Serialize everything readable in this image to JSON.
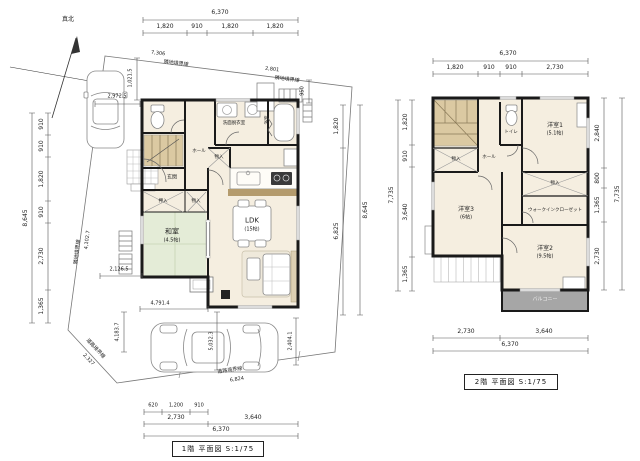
{
  "meta": {
    "north_label": "真北"
  },
  "floor1": {
    "title": "1階 平面図 S:1/75",
    "dims": {
      "top_total": "6,370",
      "top_segments": [
        "1,820",
        "910",
        "1,820",
        "1,820"
      ],
      "bottom_small": [
        "620",
        "1,200",
        "910"
      ],
      "bottom_mid": [
        "2,730",
        "3,640"
      ],
      "bottom_total": "6,370",
      "left_segments": [
        "910",
        "910",
        "1,820",
        "910",
        "2,730",
        "1,365"
      ],
      "left_total": "8,645",
      "right_segments": [
        "1,820",
        "6,825"
      ],
      "right_total": "8,645",
      "bath_offset": "950",
      "approach_offset": "1,021.5"
    },
    "rooms": {
      "genkan": "玄関",
      "hall": "ホール",
      "washitsu": "和室",
      "washitsu_size": "(4.5帖)",
      "ldk": "LDK",
      "ldk_size": "(15帖)",
      "senmen": "洗面脱衣室",
      "bath": "浴室",
      "oshiire": "押入",
      "monoire_a": "物入",
      "monoire_b": "物入"
    },
    "site": {
      "b_top_label": "隣地境界線",
      "b_top_value": "7,306",
      "b_topright_label": "隣地境界線",
      "b_topright_value": "2,801",
      "b_left_label": "隣地境界線",
      "b_left_value": "4,102.7",
      "b_leftbottom_label": "道路境界線",
      "b_leftbottom_value": "2,327",
      "b_bottom_label": "道路境界線",
      "b_bottom_value": "6,824",
      "d_car_top": "2,972.5",
      "d_left_mid": "2,126.5",
      "d_bottom_top": "4,791.4",
      "d_bottom_left": "4,183.7",
      "d_bottom_mid": "5,032.3",
      "d_bottom_right": "2,404.1"
    }
  },
  "floor2": {
    "title": "2階 平面図 S:1/75",
    "dims": {
      "top_total": "6,370",
      "top_segments": [
        "1,820",
        "910",
        "910",
        "2,730"
      ],
      "bottom_segments": [
        "2,730",
        "3,640"
      ],
      "bottom_total": "6,370",
      "left_segments": [
        "1,820",
        "910",
        "3,640",
        "1,365"
      ],
      "left_total": "7,735",
      "right_segments": [
        "2,840",
        "800",
        "1,365",
        "2,730"
      ],
      "right_total": "7,735"
    },
    "rooms": {
      "yoshitsu1": "洋室1",
      "yoshitsu1_size": "(5.1帖)",
      "yoshitsu2": "洋室2",
      "yoshitsu2_size": "(9.5帖)",
      "yoshitsu3": "洋室3",
      "yoshitsu3_size": "(6帖)",
      "wic": "ウォークインクローゼット",
      "hall": "ホール",
      "toilet": "トイレ",
      "monoire_a": "物入",
      "monoire_b": "物入",
      "balcony": "バルコニー"
    }
  }
}
